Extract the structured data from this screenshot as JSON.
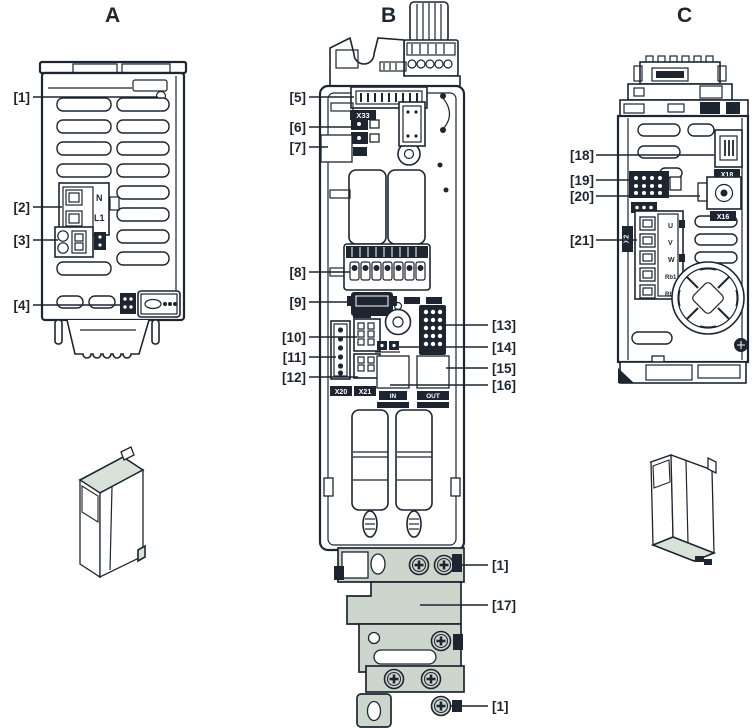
{
  "diagram": {
    "views": {
      "a": {
        "title": "A"
      },
      "b": {
        "title": "B"
      },
      "c": {
        "title": "C"
      }
    },
    "callouts": {
      "a1": "[1]",
      "a2": "[2]",
      "a3": "[3]",
      "a4": "[4]",
      "b5": "[5]",
      "b6": "[6]",
      "b7": "[7]",
      "b8": "[8]",
      "b9": "[9]",
      "b10": "[10]",
      "b11": "[11]",
      "b12": "[12]",
      "b13": "[13]",
      "b14": "[14]",
      "b15": "[15]",
      "b16": "[16]",
      "b1_top": "[1]",
      "b17": "[17]",
      "b1_bottom": "[1]",
      "c18": "[18]",
      "c19": "[19]",
      "c20": "[20]",
      "c21": "[21]"
    },
    "part_labels": {
      "n": "N",
      "l1": "L1",
      "x33": "X33",
      "x20": "X20",
      "x21": "X21",
      "in": "IN",
      "out": "OUT",
      "x18": "X18",
      "x16": "X16",
      "x2": "X2",
      "pin_u": "U",
      "pin_v": "V",
      "pin_w": "W",
      "pin_rb1": "Rb1",
      "pin_rb2": "Rb2"
    },
    "colors": {
      "line": "#1d2530",
      "shade": "#d9e2d8",
      "metal_plate": "#ccd6cd",
      "background": "#ffffff"
    }
  }
}
